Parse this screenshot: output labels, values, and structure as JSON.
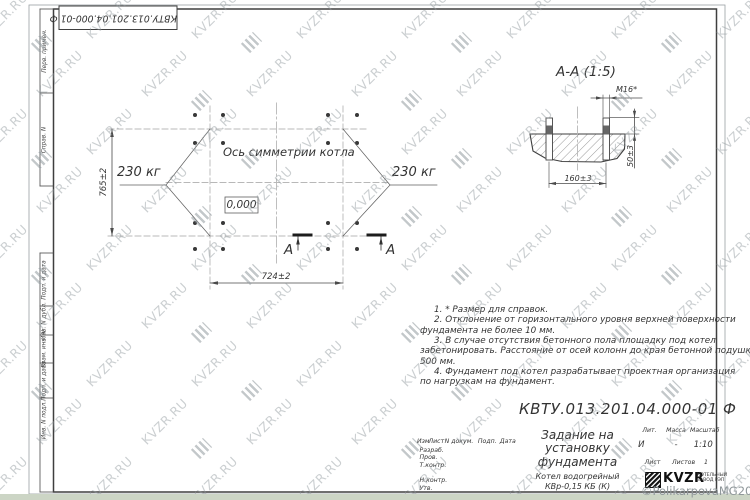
{
  "watermark": {
    "text": "KVZR.RU",
    "copyright": "©PolikarpovaMG2021"
  },
  "corner_stamp": {
    "designation": "КВТУ.013.201.04.000-01 Ф"
  },
  "side_strip": {
    "cells": [
      "Перв. примен.",
      "Справ. N",
      "Подп. и дата",
      "Инв. N дубл.",
      "Взам. инв. N",
      "Подп. и дата",
      "Инв. N подл."
    ]
  },
  "plan": {
    "symmetry_axis_label": "Ось симметрии котла",
    "elevation_mark": "0,000",
    "load_left": "230 кг",
    "load_right": "230 кг",
    "dim_height": "765±2",
    "dim_width": "724±2",
    "section_letter_left": "А",
    "section_letter_right": "А"
  },
  "section": {
    "title": "А-А (1:5)",
    "bolt_thread": "М16*",
    "dim_bolt_spacing": "160±3",
    "dim_protrusion": "50±3"
  },
  "notes": {
    "lines": [
      {
        "text": "1. * Размер для справок.",
        "indent": true
      },
      {
        "text": "2. Отклонение от горизонтального уровня верхней поверхности",
        "indent": true
      },
      {
        "text": "фундамента не более 10 мм.",
        "indent": false
      },
      {
        "text": "3. В случае отсутствия бетонного пола площадку под котел",
        "indent": true
      },
      {
        "text": "забетонировать. Расстояние от осей колонн до края бетонной подушки",
        "indent": false
      },
      {
        "text": "500 мм.",
        "indent": false
      },
      {
        "text": "4. Фундамент под котел разрабатывает проектная организация",
        "indent": true
      },
      {
        "text": "по нагрузкам на фундамент.",
        "indent": false
      }
    ]
  },
  "title_block": {
    "designation": "КВТУ.013.201.04.000-01 Ф",
    "title_lines": [
      "Задание на",
      "установку",
      "фундамента"
    ],
    "product_lines": [
      "Котел водогрейный",
      "КВр-0,15 КБ (К)"
    ],
    "col_izm": "Изм",
    "col_list": "Лист",
    "col_ndoc": "N докум.",
    "col_podp": "Подп.",
    "col_data": "Дата",
    "row_razrab": "Разраб.",
    "row_prov": "Пров.",
    "row_tkontr": "Т.контр.",
    "row_nkontr": "Н.контр.",
    "row_utv": "Утв.",
    "lit_header": "Лит.",
    "mass_header": "Масса",
    "scale_header": "Масштаб",
    "lit_value": "И",
    "mass_value": "-",
    "scale_value": "1:10",
    "sheet_label": "Лист",
    "sheets_label": "Листов",
    "sheets_value": "1",
    "logo_name": "KVZR",
    "logo_line1": "КОТЕЛЬНЫЙ",
    "logo_line2": "ЗАВОД РЭП"
  }
}
